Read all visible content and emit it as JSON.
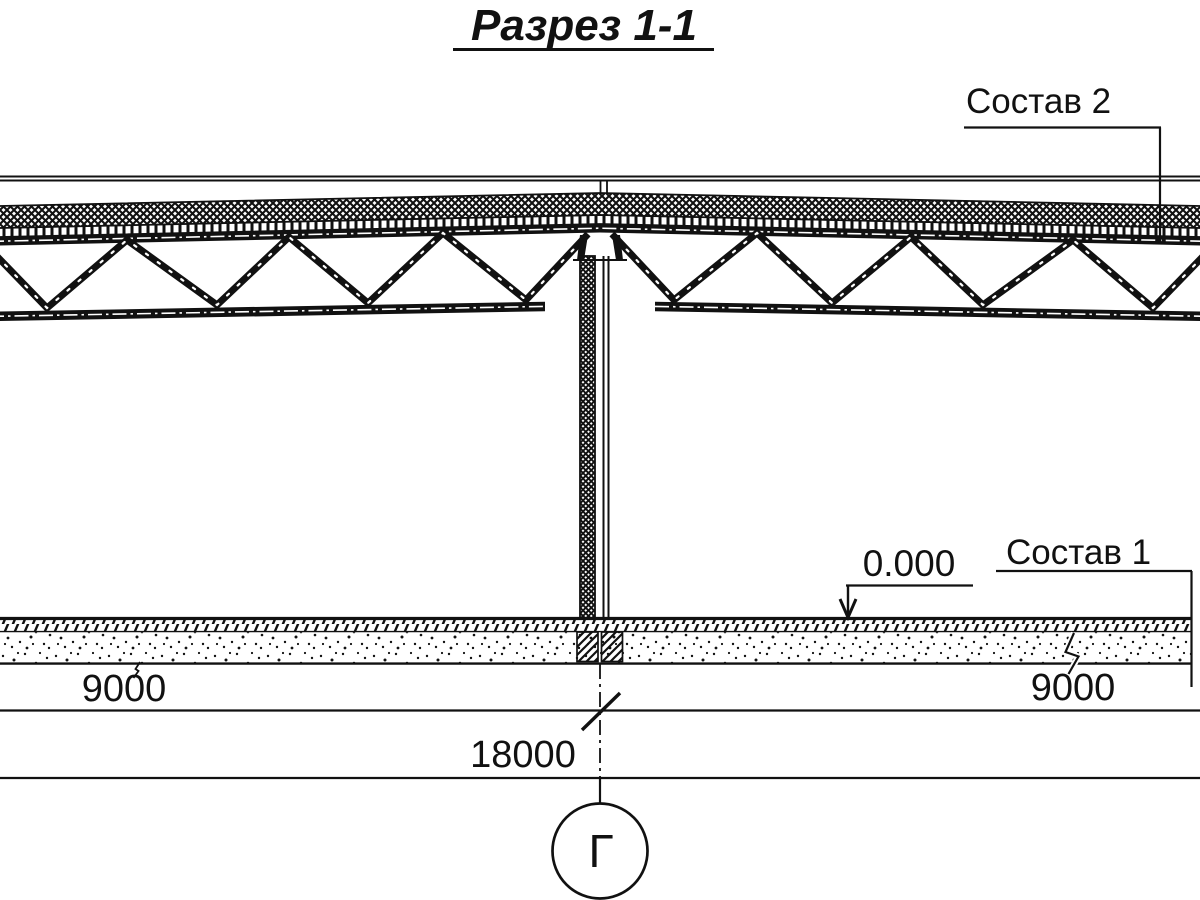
{
  "title": "Разрез 1-1",
  "callouts": {
    "roof_composition": "Состав 2",
    "floor_composition": "Состав 1"
  },
  "elevation_mark": "0.000",
  "dimensions": {
    "left_bay": "9000",
    "right_bay": "9000",
    "total": "18000"
  },
  "axis_label": "Г",
  "colors": {
    "ink": "#111111",
    "paper": "#ffffff"
  }
}
